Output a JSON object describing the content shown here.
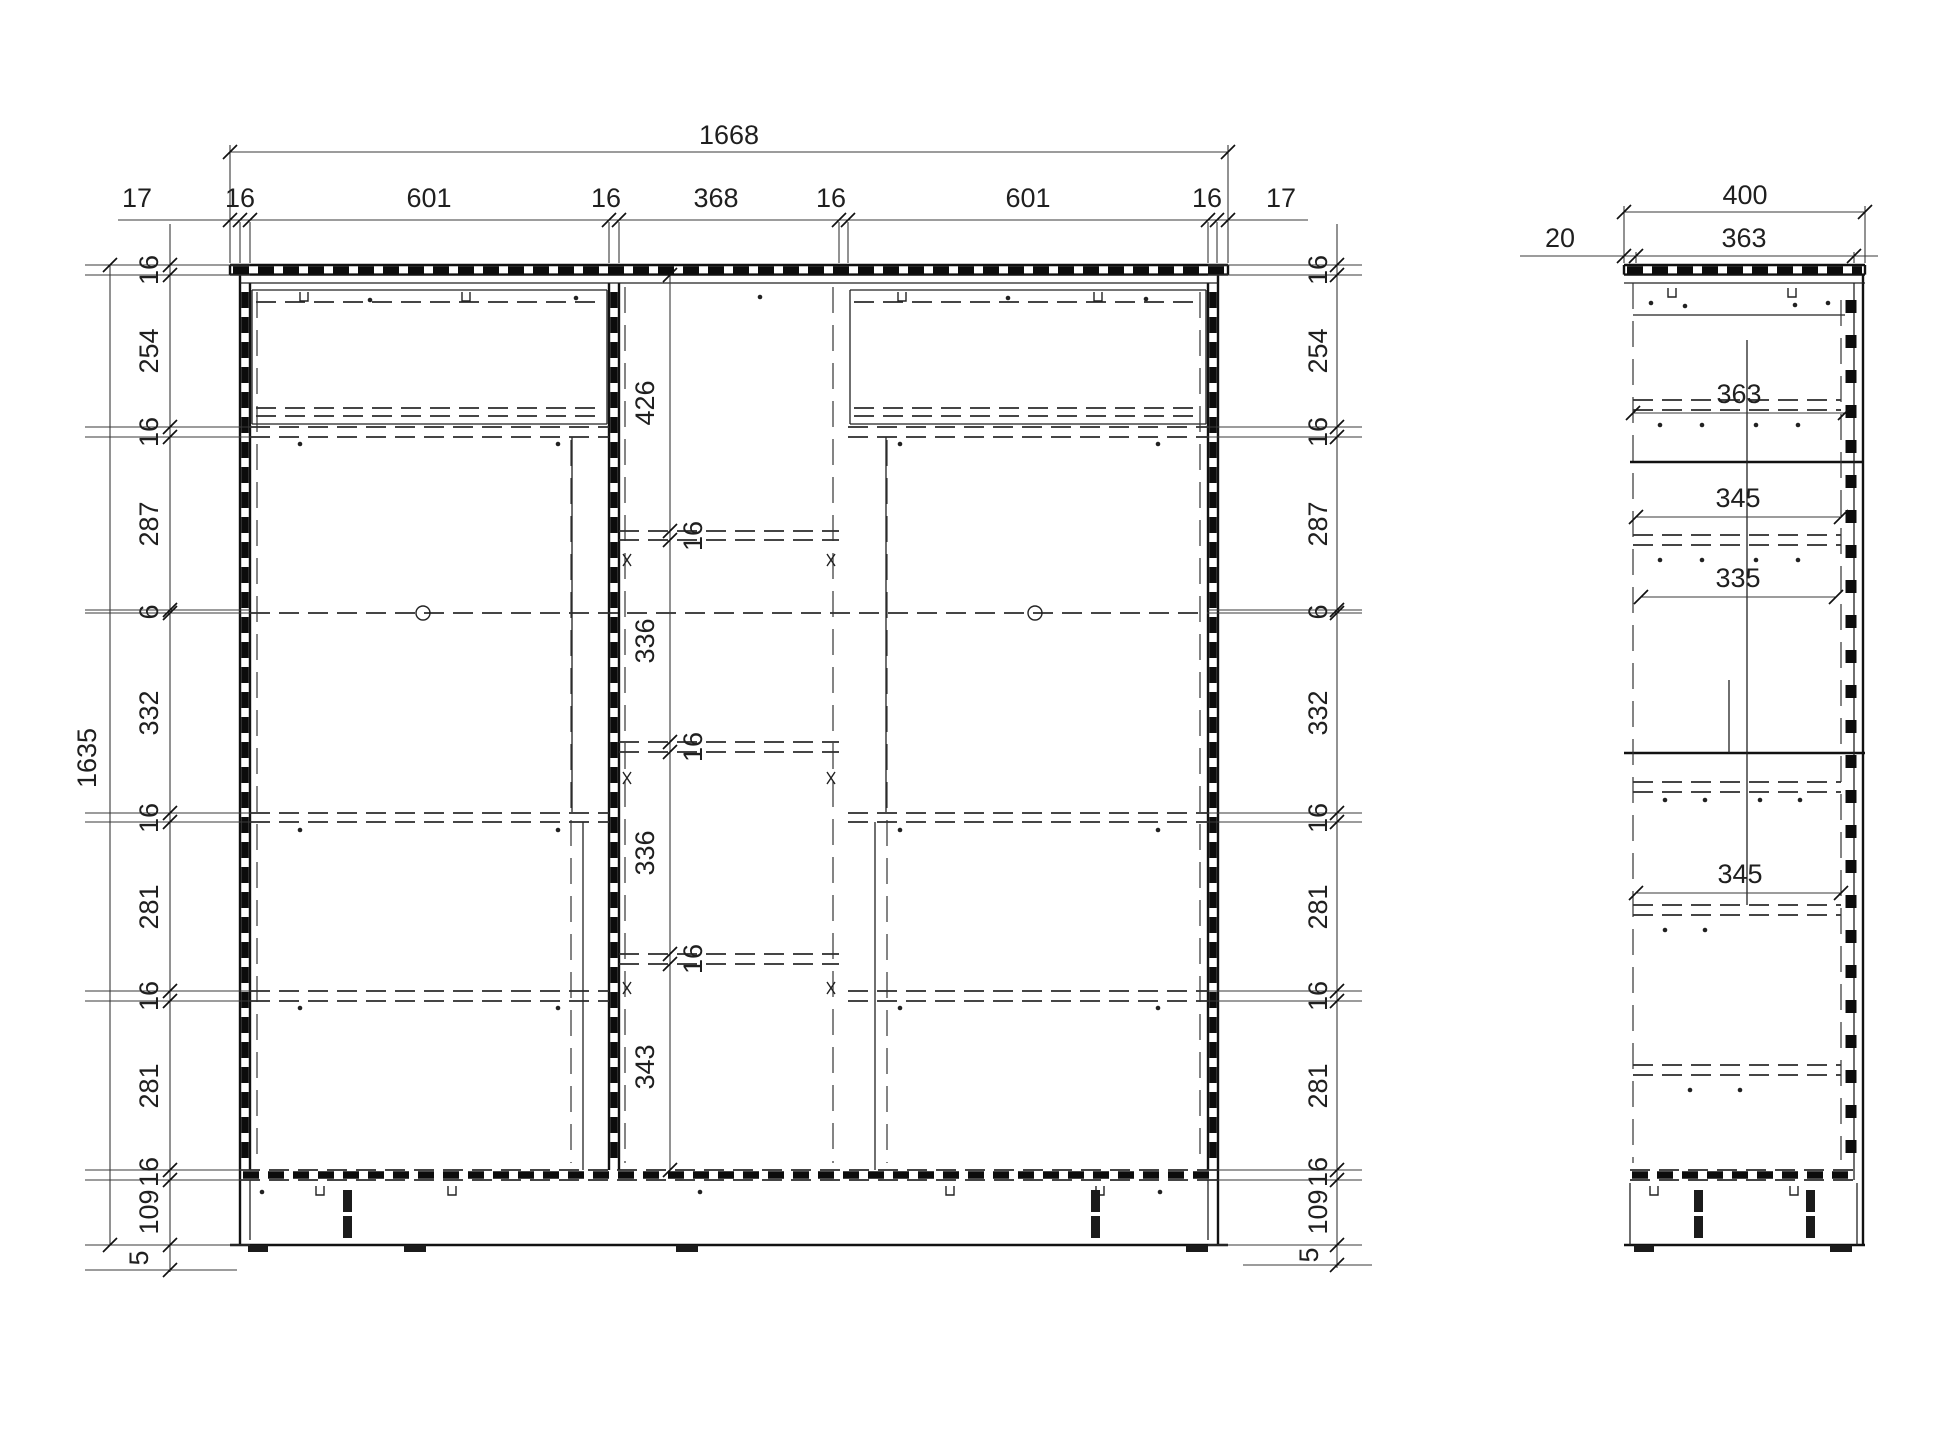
{
  "front": {
    "overall_width": "1668",
    "overall_height": "1635",
    "floor_clearance": "5",
    "top_chain": [
      "17",
      "16",
      "601",
      "16",
      "368",
      "16",
      "601",
      "16",
      "17"
    ],
    "left_chain": [
      "16",
      "254",
      "16",
      "287",
      "6",
      "332",
      "16",
      "281",
      "16",
      "281",
      "16",
      "109"
    ],
    "right_chain": [
      "16",
      "254",
      "16",
      "287",
      "6",
      "332",
      "16",
      "281",
      "16",
      "281",
      "16",
      "109"
    ],
    "center_chain": [
      "426",
      "16",
      "336",
      "16",
      "336",
      "16",
      "343"
    ]
  },
  "side": {
    "overall_depth": "400",
    "back_panel_offset": "20",
    "top_depth": "363",
    "interior_depths": [
      "363",
      "345",
      "335",
      "345"
    ]
  }
}
